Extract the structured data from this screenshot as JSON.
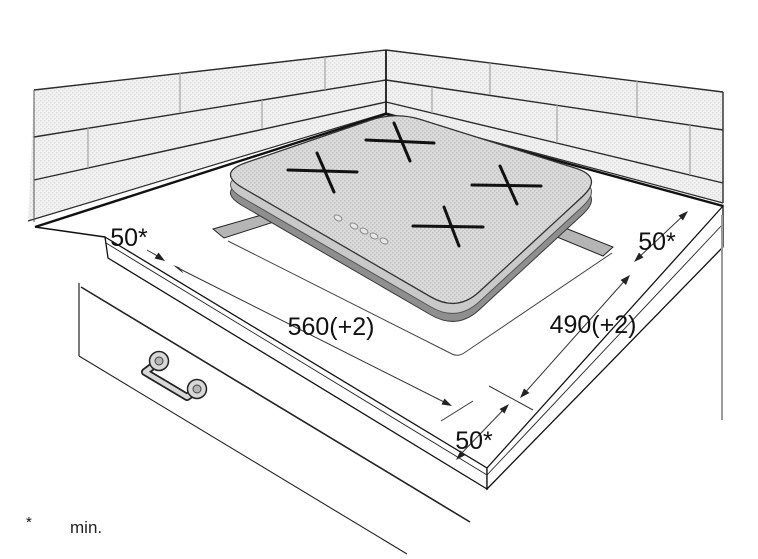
{
  "diagram": {
    "type": "hob-installation-drawing",
    "dimensions": {
      "clearance_left": "50*",
      "cutout_width": "560(+2)",
      "cutout_depth": "490(+2)",
      "clearance_right": "50*",
      "clearance_front": "50*"
    },
    "footnote": {
      "symbol": "*",
      "text": "min."
    },
    "colors": {
      "line": "#1a1a1a",
      "wall_tile": "#ececec",
      "glass": "#d4d4d4",
      "rim": "#c9c9c9",
      "shadow": "#8f8f8f",
      "cutout": "#b5b5b5",
      "background": "#ffffff"
    }
  }
}
